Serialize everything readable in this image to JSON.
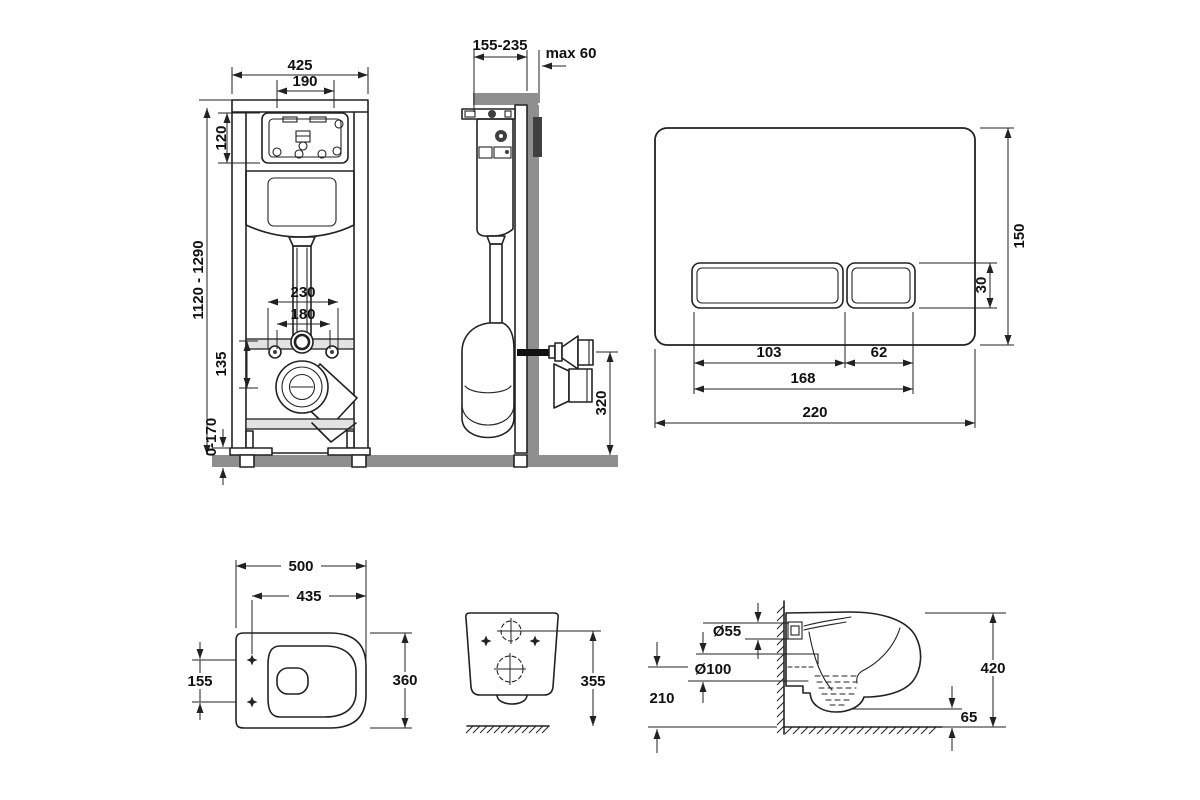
{
  "colors": {
    "line": "#222222",
    "wall_gray": "#8f8f8f",
    "dark_block": "#3f3f3f",
    "background": "#ffffff"
  },
  "dims": {
    "frame_front": {
      "width": "425",
      "opening_width": "190",
      "opening_height": "120",
      "height_range": "1120 - 1290",
      "bolts_outer": "230",
      "bolts_inner": "180",
      "drain_drop": "135",
      "foot_adjust": "0-170"
    },
    "frame_side": {
      "depth_range": "155-235",
      "wall_max": "max 60",
      "outlet_height": "320"
    },
    "flush_plate": {
      "height": "150",
      "button_height": "30",
      "button_left": "103",
      "button_right": "62",
      "buttons_width": "168",
      "width": "220"
    },
    "bowl_top": {
      "length": "500",
      "inner_length": "435",
      "hole_spacing": "155",
      "width": "360"
    },
    "bowl_rear": {
      "height": "355"
    },
    "bowl_side": {
      "inlet_dia": "Ø55",
      "outlet_dia": "Ø100",
      "outlet_height": "210",
      "rim_height": "420",
      "clearance": "65"
    }
  }
}
